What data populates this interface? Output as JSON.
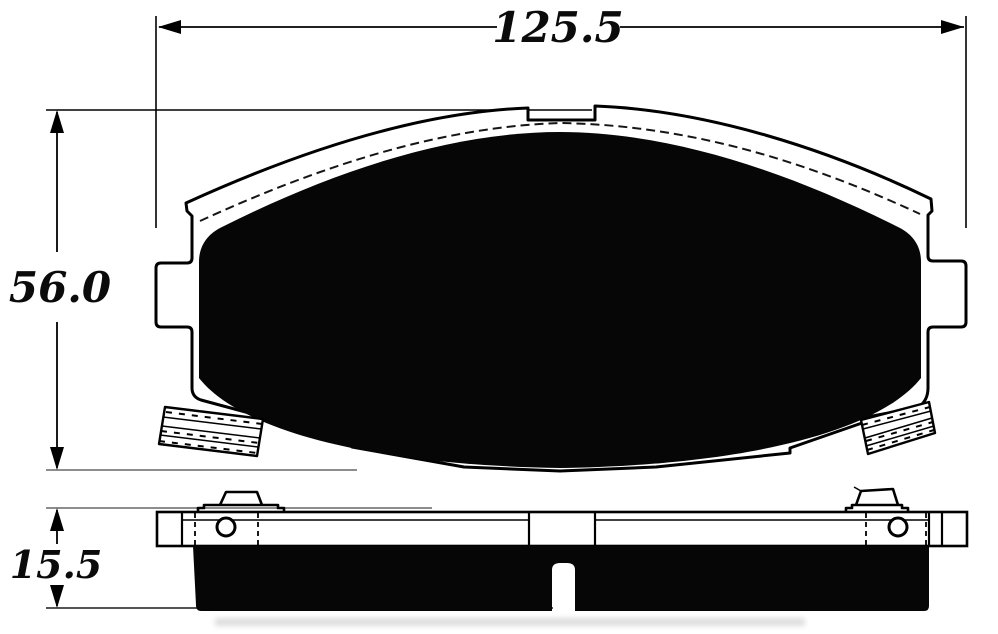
{
  "drawing": {
    "type": "brake-pad-dimensional-drawing",
    "views": [
      "pad face view",
      "pad edge view"
    ],
    "background": "#ffffff"
  },
  "colors": {
    "line": "#000000",
    "extension_line": "#7d7d7d",
    "friction": "#060606",
    "plate": "#ffffff"
  },
  "dimensions": {
    "width": {
      "label": "125.5"
    },
    "height": {
      "label": "56.0"
    },
    "thickness": {
      "label": "15.5"
    }
  }
}
